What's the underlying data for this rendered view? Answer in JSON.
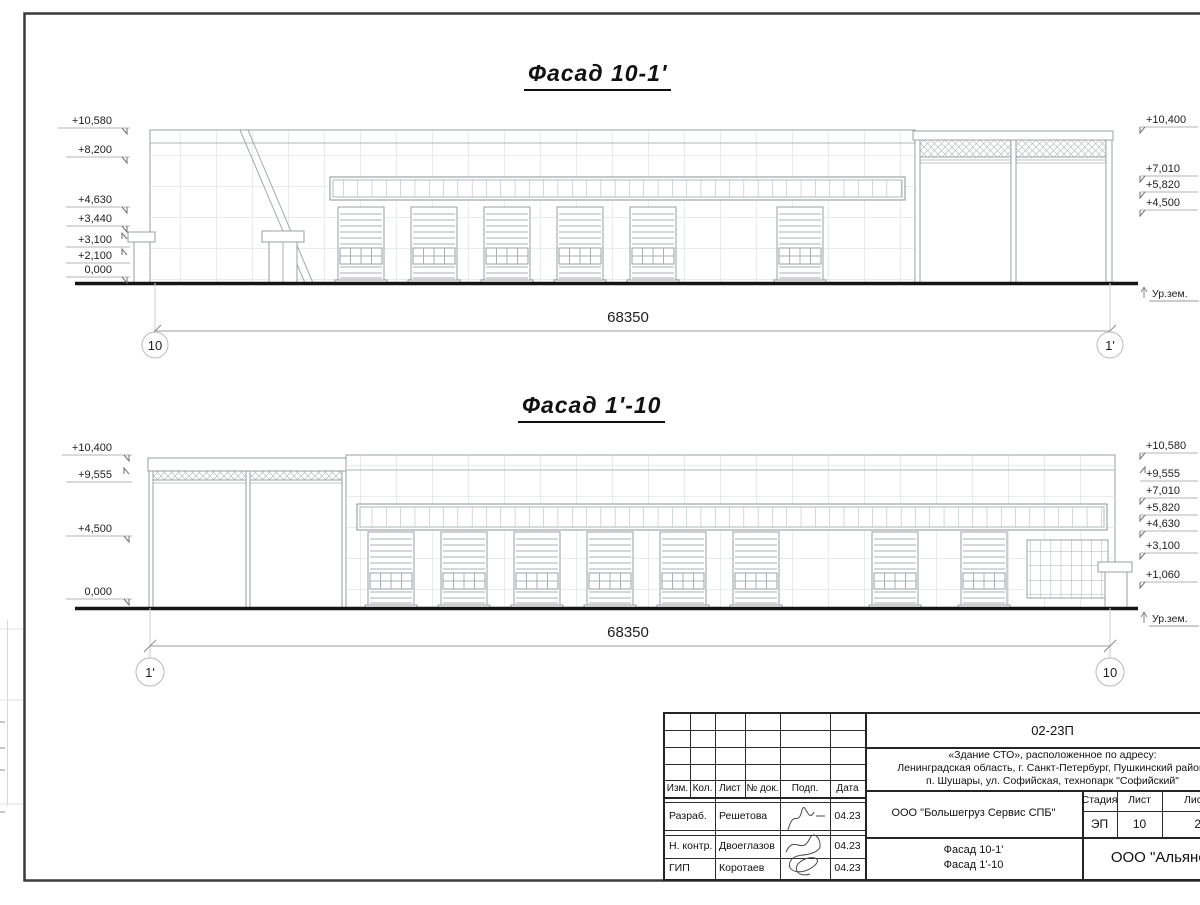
{
  "sheet": {
    "facade_top": {
      "title": "Фасад 10-1'",
      "dimension": "68350",
      "axis_left": "10",
      "axis_right": "1'",
      "ground": "Ур.зем.",
      "marks_left": [
        "+10,580",
        "+8,200",
        "+4,630",
        "+3,440",
        "+3,100",
        "+2,100",
        "0,000"
      ],
      "marks_right": [
        "+10,400",
        "+7,010",
        "+5,820",
        "+4,500"
      ]
    },
    "facade_bottom": {
      "title": "Фасад 1'-10",
      "dimension": "68350",
      "axis_left": "1'",
      "axis_right": "10",
      "ground": "Ур.зем.",
      "marks_left": [
        "+10,400",
        "+9,555",
        "+4,500",
        "0,000"
      ],
      "marks_right": [
        "+10,580",
        "+9,555",
        "+7,010",
        "+5,820",
        "+4,630",
        "+3,100",
        "+1,060"
      ]
    },
    "title_block": {
      "code": "02-23П",
      "address_line1": "«Здание СТО», расположенное по адресу:",
      "address_line2": "Ленинградская область, г. Санкт-Петербург, Пушкинский район,",
      "address_line3": "п. Шушары, ул. Софийская, технопарк \"Софийский\"",
      "col_izm": "Изм.",
      "col_kol": "Кол.",
      "col_list": "Лист",
      "col_doc": "№ док.",
      "col_podp": "Подп.",
      "col_data": "Дата",
      "row1_role": "Разраб.",
      "row1_name": "Решетова",
      "row1_date": "04.23",
      "row2_role": "Н. контр.",
      "row2_name": "Двоеглазов",
      "row2_date": "04.23",
      "row3_role": "ГИП",
      "row3_name": "Коротаев",
      "row3_date": "04.23",
      "company": "ООО \"Большегруз Сервис СПБ\"",
      "stage_label": "Стадия",
      "stage_value": "ЭП",
      "sheet_label": "Лист",
      "sheet_value": "10",
      "sheets_label": "Листов",
      "sheets_value": "21",
      "drawing_name1": "Фасад 10-1'",
      "drawing_name2": "Фасад 1'-10",
      "contractor": "ООО \"Альянс\""
    },
    "colors": {
      "line_light": "#9aa3a3",
      "line_ground": "#151515",
      "frame": "#3a3a3a"
    }
  }
}
